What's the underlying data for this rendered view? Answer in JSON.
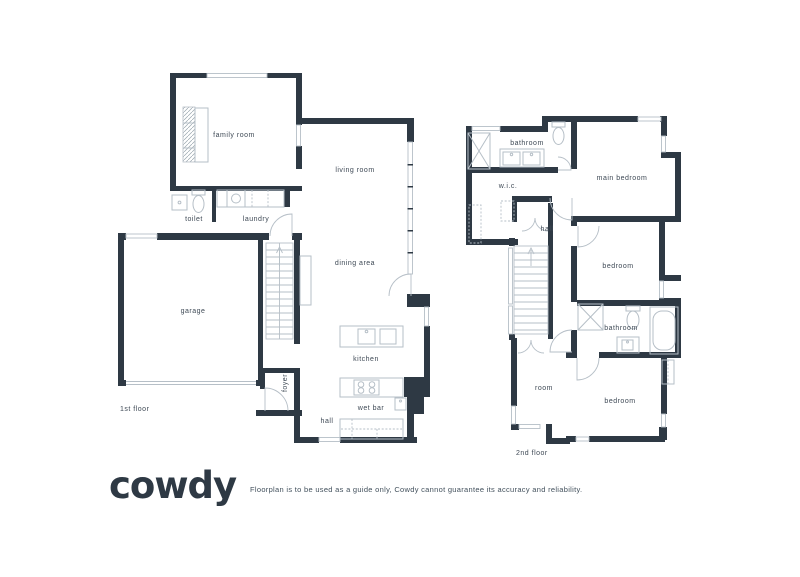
{
  "colors": {
    "wall": "#2e3944",
    "fixture": "#b6bfc7",
    "text": "#3e4955",
    "background": "#ffffff"
  },
  "floor1": {
    "label": "1st floor",
    "rooms": {
      "family_room": "family room",
      "living_room": "living room",
      "toilet": "toilet",
      "laundry": "laundry",
      "garage": "garage",
      "dining_area": "dining area",
      "kitchen": "kitchen",
      "foyer": "foyer",
      "wet_bar": "wet bar",
      "hall": "hall"
    }
  },
  "floor2": {
    "label": "2nd floor",
    "rooms": {
      "bathroom_top": "bathroom",
      "wic": "w.i.c.",
      "main_bedroom": "main bedroom",
      "hall": "hall",
      "bedroom_middle": "bedroom",
      "bathroom_lower": "bathroom",
      "room": "room",
      "bedroom_bottom": "bedroom"
    }
  },
  "footer": {
    "logo": "cowdy",
    "disclaimer": "Floorplan is to be used as a guide only, Cowdy cannot guarantee its accuracy and reliability."
  }
}
